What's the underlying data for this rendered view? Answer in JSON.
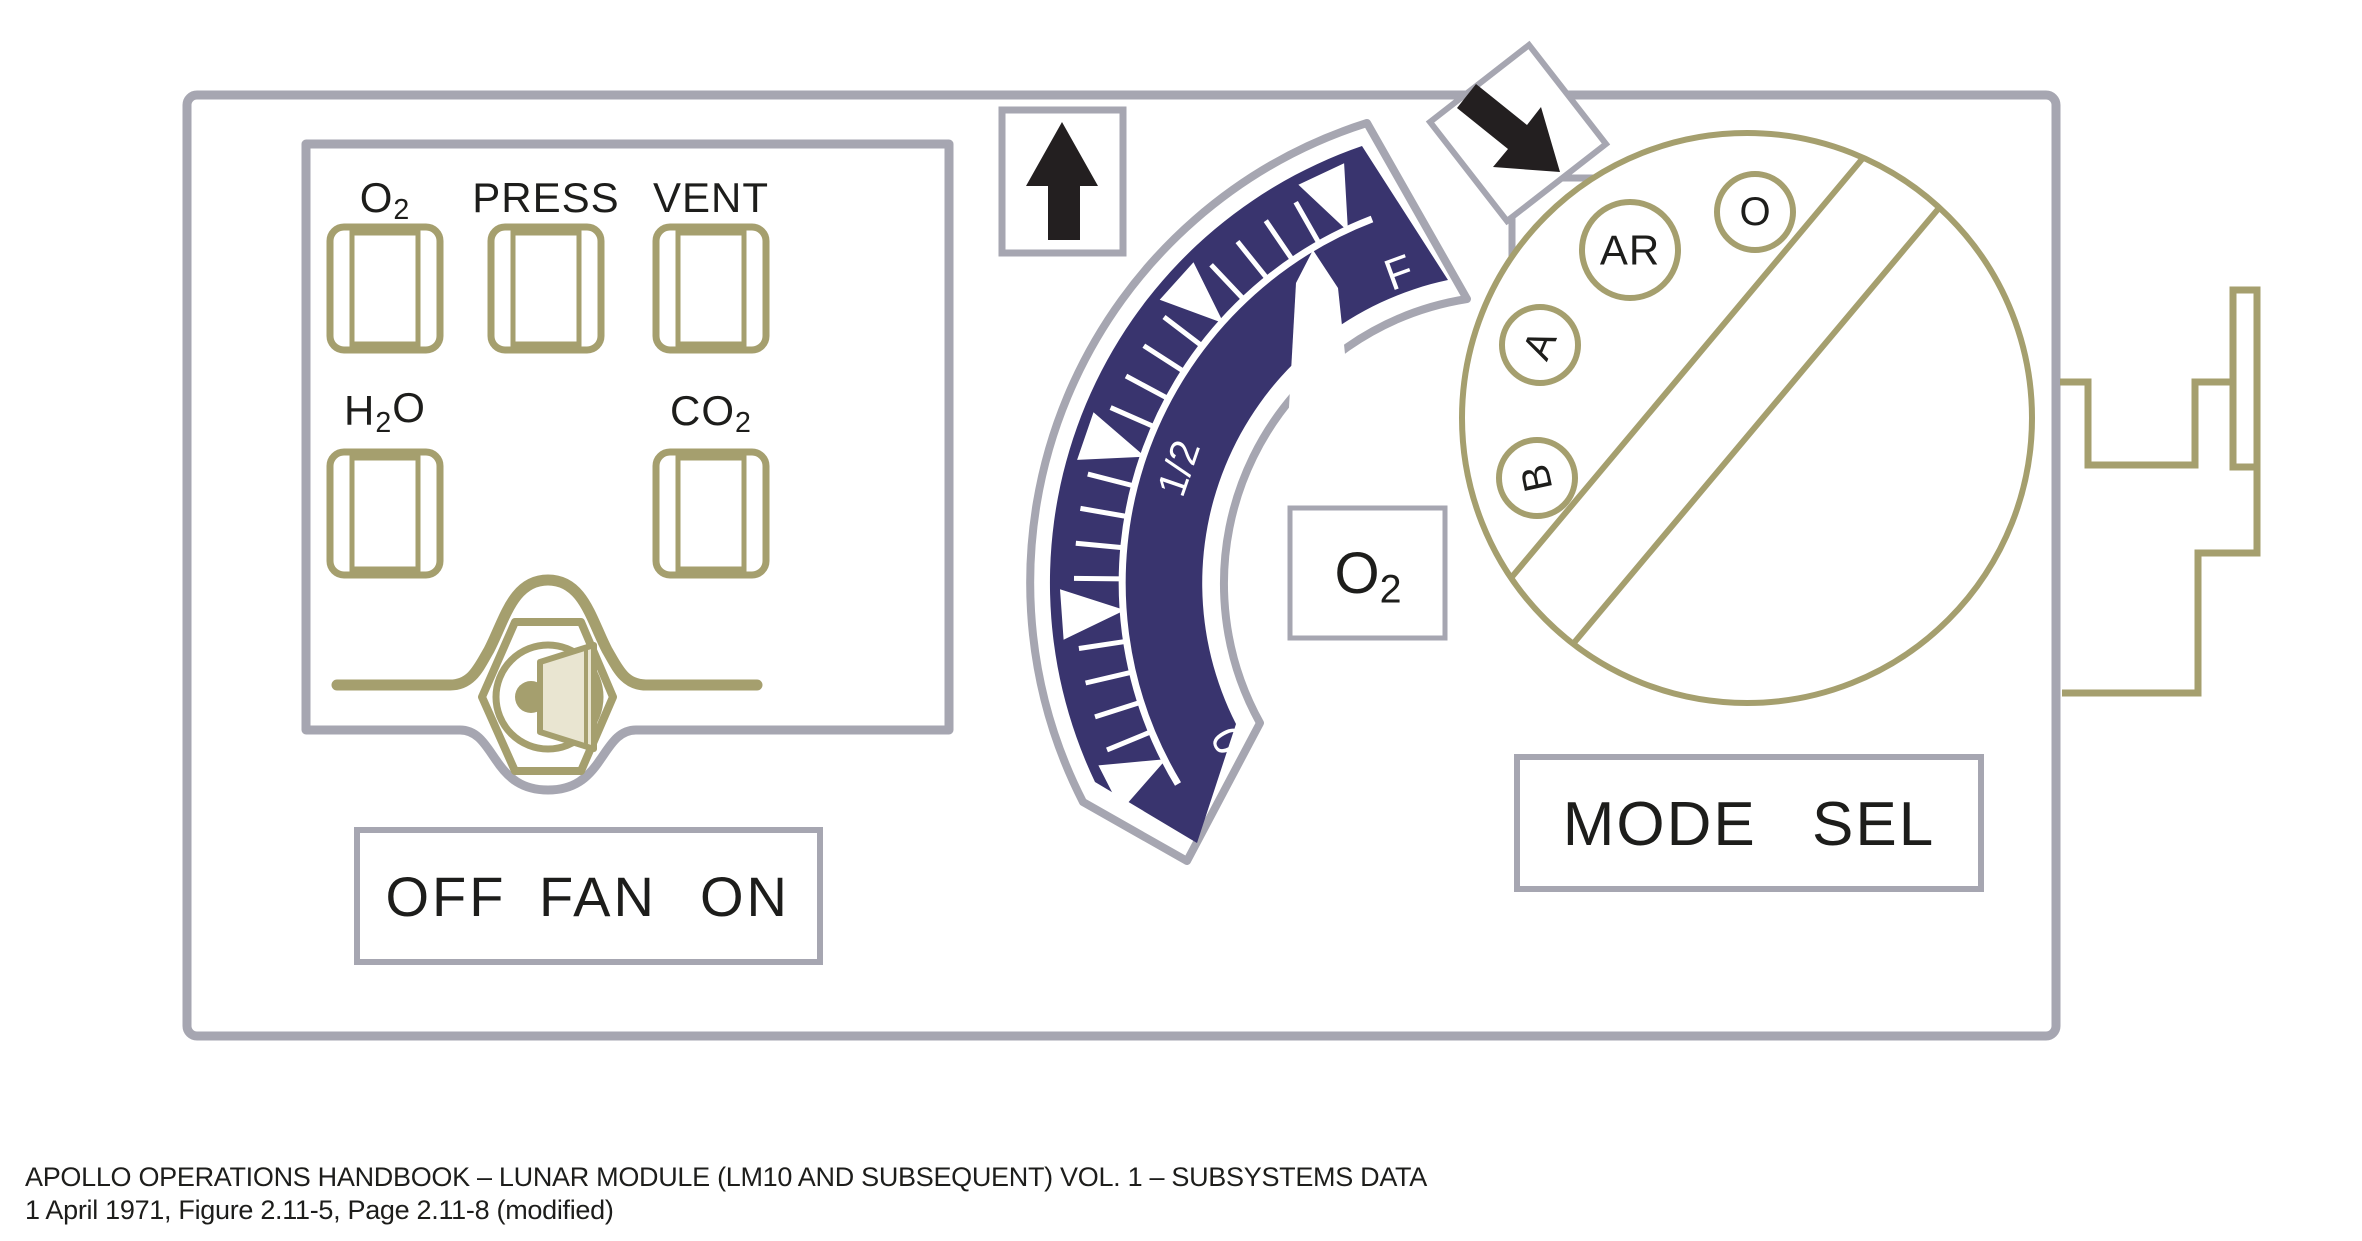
{
  "colors": {
    "gray": "#a6a6b1",
    "olive": "#a59f6e",
    "navy": "#39346e",
    "beige": "#e9e5d1",
    "ink": "#1d1d1b"
  },
  "indicator_panel": {
    "windows": [
      {
        "name": "o2",
        "label_parts": [
          [
            "O",
            0
          ],
          [
            "2",
            1
          ]
        ]
      },
      {
        "name": "press",
        "label_parts": [
          [
            "PRESS",
            0
          ]
        ]
      },
      {
        "name": "vent",
        "label_parts": [
          [
            "VENT",
            0
          ]
        ]
      },
      {
        "name": "h2o",
        "label_parts": [
          [
            "H",
            0
          ],
          [
            "2",
            1
          ],
          [
            "O",
            0
          ]
        ]
      },
      {
        "name": "co2",
        "label_parts": [
          [
            "CO",
            0
          ],
          [
            "2",
            1
          ]
        ]
      }
    ]
  },
  "fan_switch": {
    "labels": {
      "off": "OFF",
      "center": "FAN",
      "on": "ON"
    }
  },
  "gauge": {
    "label_parts": [
      [
        "O",
        0
      ],
      [
        "2",
        1
      ]
    ],
    "scale": {
      "center": [
        1512,
        583
      ],
      "scale_radius": 390,
      "minor_tick_inner": 390,
      "minor_tick_outer": 438,
      "major_tip_radius": 388,
      "major_base_radius": 452,
      "major_half_angle": 3.2,
      "major_angles": [
        115,
        138,
        161,
        184,
        207
      ],
      "minor_angles": [
        119.6,
        124.2,
        128.8,
        133.4,
        142.6,
        147.2,
        151.8,
        156.4,
        165.6,
        170.2,
        174.8,
        179.4,
        188.6,
        193.2,
        197.8,
        202.4
      ],
      "labels": [
        {
          "text": "F",
          "angle": 110,
          "radius": 330,
          "rotate": -20,
          "size": 44
        },
        {
          "text": "1/2",
          "angle": 161,
          "radius": 352,
          "rotate": -71,
          "size": 40
        },
        {
          "text": "0",
          "angle": 209,
          "radius": 325,
          "rotate": -119,
          "size": 42
        }
      ]
    }
  },
  "mode_selector": {
    "label": "MODE SEL",
    "positions": [
      {
        "text": "AR"
      },
      {
        "text": "O"
      },
      {
        "text": "A"
      },
      {
        "text": "B"
      }
    ]
  },
  "icons": {
    "up_arrow": "black-up-arrow",
    "rotate_arrow": "black-diagonal-down-right-arrow"
  },
  "caption": {
    "line1": "APOLLO OPERATIONS HANDBOOK – LUNAR MODULE (LM10 AND SUBSEQUENT) VOL. 1 – SUBSYSTEMS DATA",
    "line2": "1 April 1971, Figure 2.11-5, Page 2.11-8 (modified)"
  }
}
